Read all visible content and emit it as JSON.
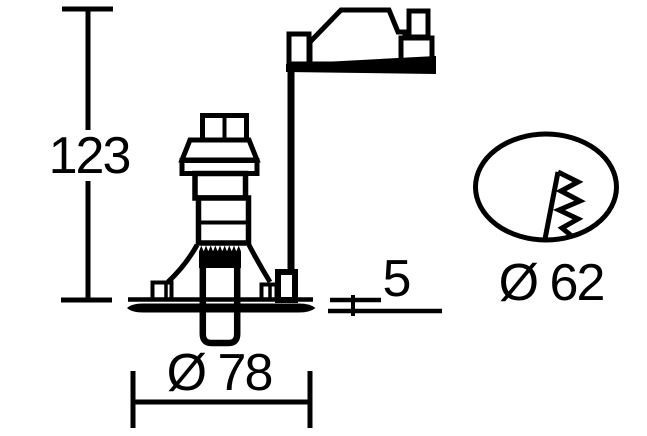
{
  "page": {
    "background_color": "#ffffff",
    "line_color": "#000000"
  },
  "drawing": {
    "kind": "technical dimension drawing",
    "labels": {
      "height": "123",
      "flange_diameter": "Ø 78",
      "flange_thickness": "5",
      "cutout_diameter": "Ø 62"
    }
  }
}
